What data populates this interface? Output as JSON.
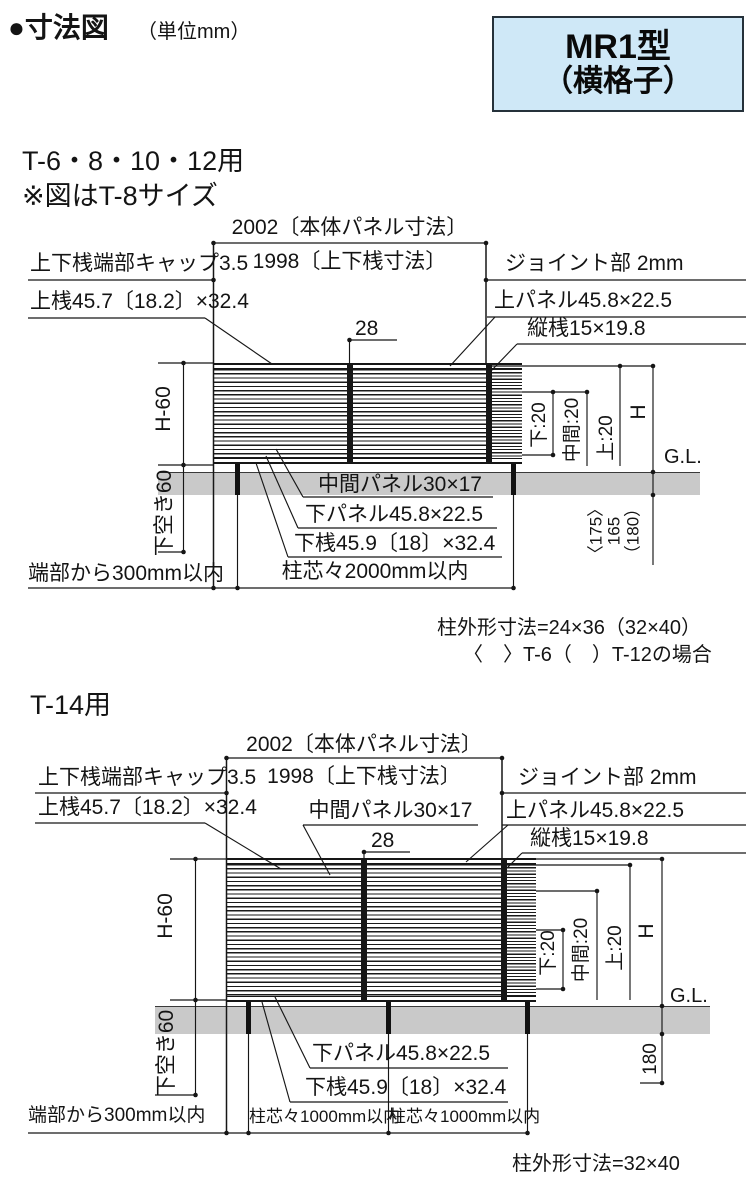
{
  "header": {
    "title": "●寸法図",
    "unit": "（単位mm）",
    "badge_line1": "MR1型",
    "badge_line2": "（横格子）"
  },
  "colors": {
    "line": "#161616",
    "ground": "#c9c9c9",
    "badge_bg": "#cfe8f7",
    "badge_border": "#25313a"
  },
  "s1": {
    "title": "T-6・8・10・12用",
    "size_note": "※図はT-8サイズ",
    "dim_panel": "2002〔本体パネル寸法〕",
    "dim_rails": "1998〔上下桟寸法〕",
    "cap": "上下桟端部キャップ3.5",
    "joint": "ジョイント部 2mm",
    "top_rail": "上桟45.7〔18.2〕×32.4",
    "top_panel": "上パネル45.8×22.5",
    "vertical_bar": "縦桟15×19.8",
    "joint_width": "28",
    "height": "H-60",
    "mid_panel": "中間パネル30×17",
    "bottom_panel": "下パネル45.8×22.5",
    "bottom_rail": "下桟45.9〔18〕×32.4",
    "bottom_gap": "下空き60",
    "edge_note": "端部から300mm以内",
    "post_pitch": "柱芯々2000mm以内",
    "lower": "下:20",
    "middle": "中間:20",
    "upper": "上:20",
    "h": "H",
    "gl": "G.L.",
    "embed_t6": "〈175〉",
    "embed": "165",
    "embed_t12": "（180）",
    "note_post": "柱外形寸法=24×36（32×40）",
    "note_variant": "〈　〉T-6（　）T-12の場合"
  },
  "s2": {
    "title": "T-14用",
    "dim_panel": "2002〔本体パネル寸法〕",
    "dim_rails": "1998〔上下桟寸法〕",
    "cap": "上下桟端部キャップ3.5",
    "joint": "ジョイント部 2mm",
    "top_rail": "上桟45.7〔18.2〕×32.4",
    "mid_panel": "中間パネル30×17",
    "top_panel": "上パネル45.8×22.5",
    "vertical_bar": "縦桟15×19.8",
    "joint_width": "28",
    "height": "H-60",
    "bottom_gap": "下空き60",
    "bottom_panel": "下パネル45.8×22.5",
    "bottom_rail": "下桟45.9〔18〕×32.4",
    "edge_note": "端部から300mm以内",
    "post_pitch1": "柱芯々1000mm以内",
    "post_pitch2": "柱芯々1000mm以内",
    "lower": "下:20",
    "middle": "中間:20",
    "upper": "上:20",
    "h": "H",
    "gl": "G.L.",
    "embed": "180",
    "note_post": "柱外形寸法=32×40"
  }
}
